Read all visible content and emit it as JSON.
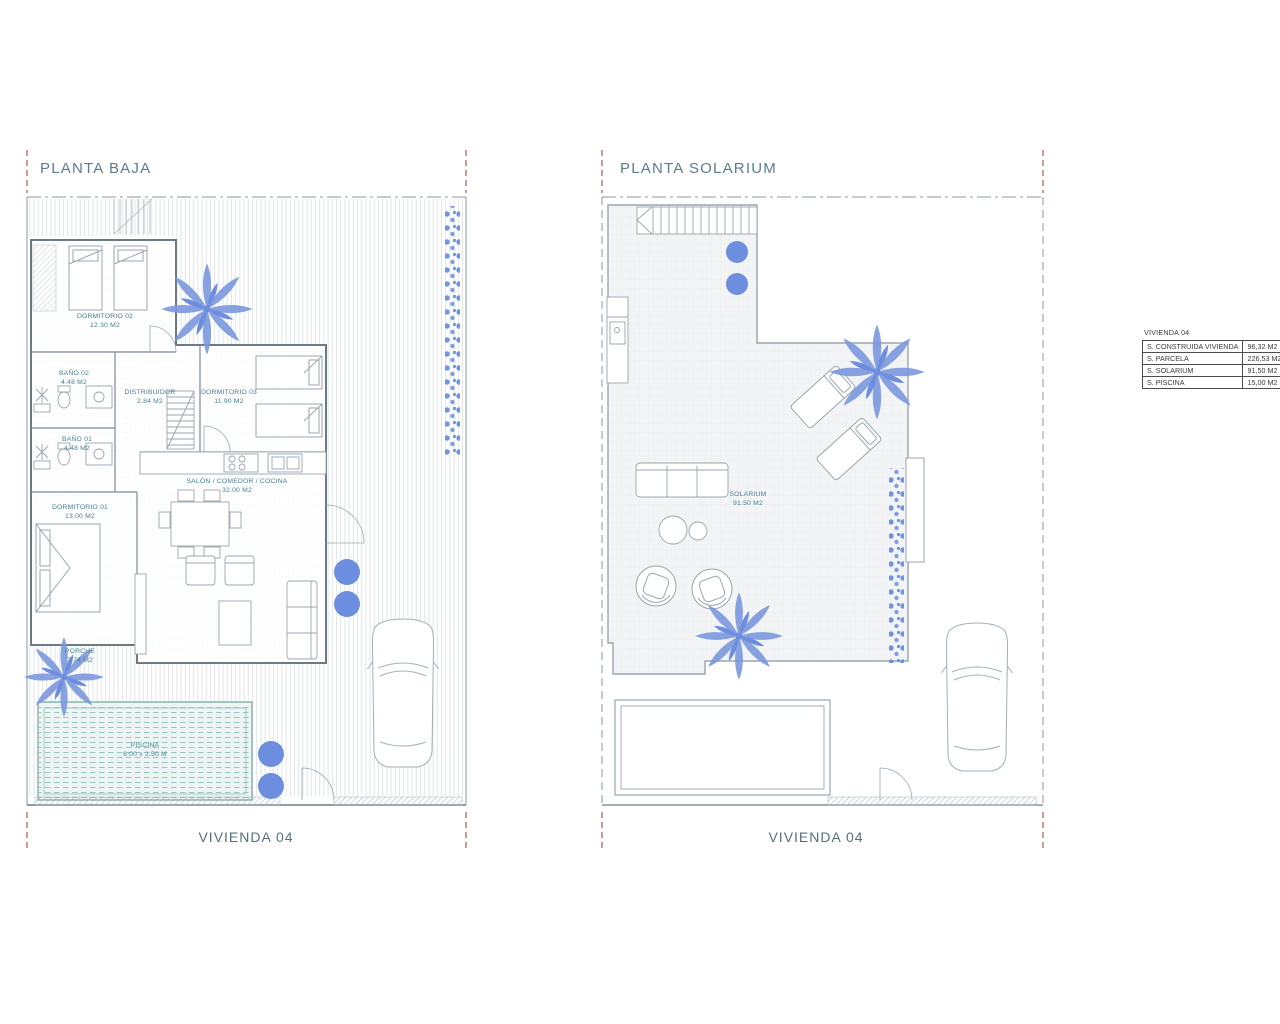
{
  "colors": {
    "linework": "#98a6b0",
    "walls": "#6c7a84",
    "room_label_text": "#45808f",
    "title_text": "#5b7d8c",
    "plant_blue": "#6d8ede",
    "plant_blue_light": "#7b97de",
    "pool_fill": "#ecf5f3",
    "pool_lines": "#96c6bf",
    "red_dash": "#b3564f",
    "table_border": "#4d4d4d"
  },
  "plans": [
    {
      "title": "PLANTA BAJA",
      "footer": "VIVIENDA 04",
      "rooms": [
        {
          "name": "DORMITORIO 02",
          "area": "12.30 M2"
        },
        {
          "name": "BAÑO 02",
          "area": "4.48 M2"
        },
        {
          "name": "DISTRIBUIDOR",
          "area": "2.84 M2"
        },
        {
          "name": "DORMITORIO 03",
          "area": "11.90 M2"
        },
        {
          "name": "BAÑO 01",
          "area": "4.48 M2"
        },
        {
          "name": "DORMITORIO 01",
          "area": "13.00 M2"
        },
        {
          "name": "SALÓN / COMEDOR / COCINA",
          "area": "32.00 M2"
        },
        {
          "name": "PORCHE",
          "area": "7.74 M2"
        },
        {
          "name": "PISCINA",
          "area": "6.00 x 2.50 M"
        }
      ]
    },
    {
      "title": "PLANTA SOLARIUM",
      "footer": "VIVIENDA 04",
      "rooms": [
        {
          "name": "SOLARIUM",
          "area": "91.50 M2"
        }
      ]
    }
  ],
  "summary_table": {
    "title": "VIVIENDA 04",
    "rows": [
      {
        "label": "S. CONSTRUIDA VIVIENDA",
        "value": "96,32 M2"
      },
      {
        "label": "S. PARCELA",
        "value": "226,53 M2"
      },
      {
        "label": "S. SOLARIUM",
        "value": "91,50 M2"
      },
      {
        "label": "S. PISCINA",
        "value": "15,00 M2"
      }
    ]
  },
  "icons": {
    "palm": "palm-tree-icon",
    "bush": "bush-icon",
    "shrub_strip": "hedge-icon",
    "car": "car-icon",
    "stairs": "stairs-icon",
    "pool": "pool-icon"
  }
}
